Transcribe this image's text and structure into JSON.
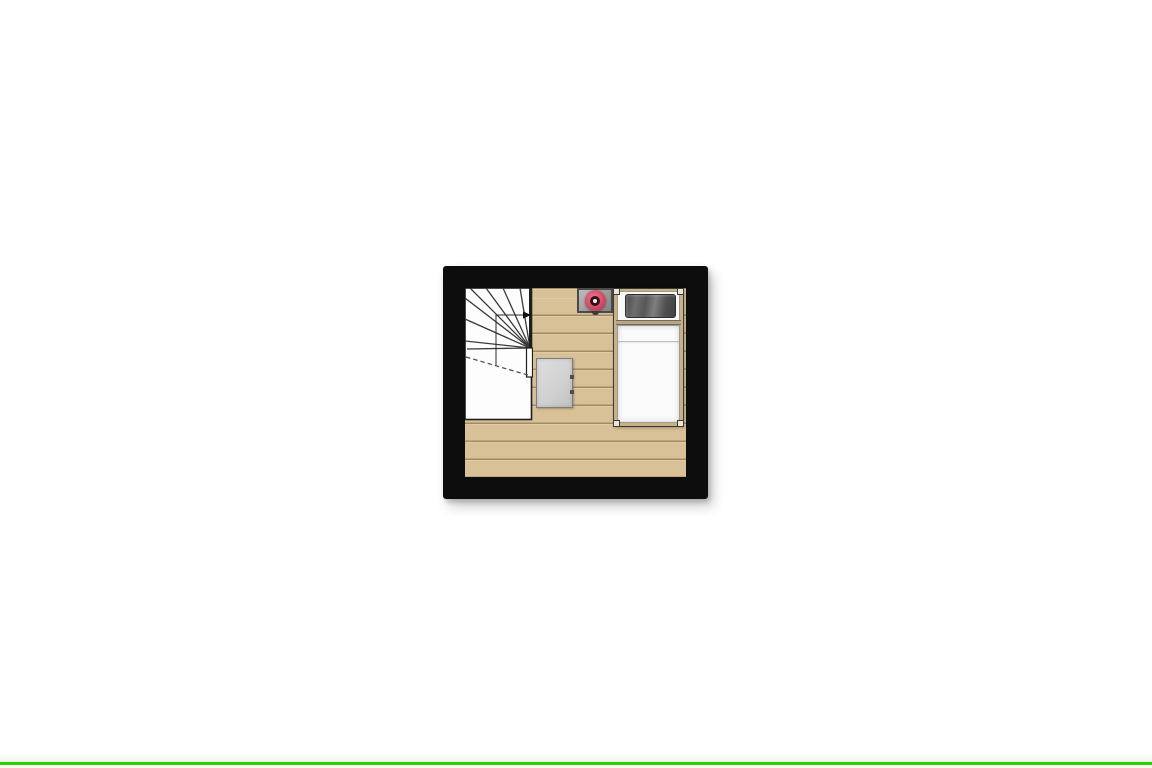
{
  "page": {
    "background_color": "#ffffff",
    "bottom_accent_line_color": "#2cd000"
  },
  "floorplan": {
    "type": "top-down floor plan, single attic room",
    "wall_color": "#0d0d0d",
    "floor_color": "#d8c197",
    "floor_plank_line_color": "#8a6d42",
    "elements": {
      "staircase": {
        "kind": "quarter-turn winder staircase with up-direction arrow and dashed headroom line",
        "fill": "#fdfdfd",
        "line_color": "#2a2a2a"
      },
      "cabinet": {
        "kind": "small storage cabinet",
        "fill": "#d2d2d2",
        "border": "#7d7d7d"
      },
      "basin_unit": {
        "kind": "gray unit with round red basin",
        "plinth_color": "#9f9f9f",
        "bowl_color": "#d14b66",
        "bowl_inner_color": "#33111b",
        "bowl_center_color": "#f3ebee"
      },
      "bed": {
        "kind": "single bed",
        "frame_color": "#c9b183",
        "headboard_color": "#f8f8f6",
        "pillow_color": "#565656",
        "mattress_color": "#fbfbfb"
      }
    }
  }
}
